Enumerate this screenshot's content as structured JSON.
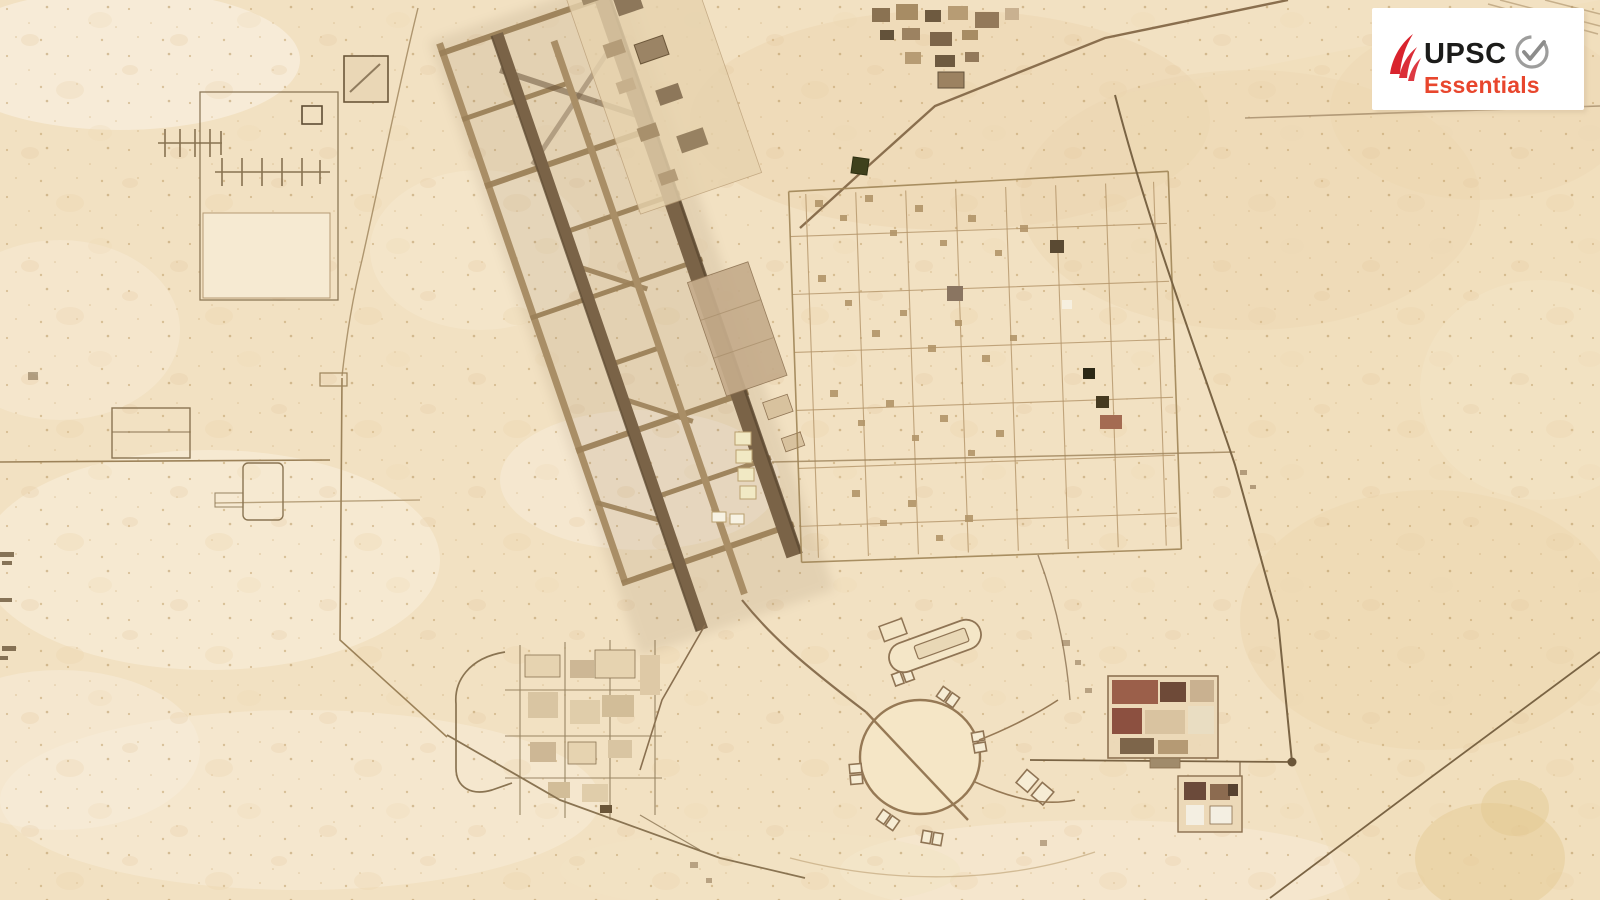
{
  "image": {
    "description": "Sepia-toned aerial satellite view of a desert airbase: two long parallel diagonal runways with taxiways and connectors, a large parking apron, dense support-facility grids to the east, a circular dispersal loop with parking pads at the south, antenna arrays and fenced compounds to the west, all surrounded by open sand.",
    "style": "satellite photograph"
  },
  "watermark": {
    "brand": "UPSC",
    "subtitle": "Essentials",
    "brand_color": "#1c1c1a",
    "subtitle_color": "#e8462d",
    "flame_color": "#d9232d",
    "check_color": "#9d9d9c",
    "card_bg": "#ffffff"
  },
  "map": {
    "colors": {
      "sand": "#f2e1c2",
      "sand_light": "#f8eeda",
      "sand_dark": "#e6cba2",
      "road": "#8a6f4e",
      "road_light": "#9c8159",
      "runway": "#7a6347",
      "taxiway": "#a98e66",
      "apron": "#c5ac8b",
      "band": "#e7d3ae",
      "building": "#9c8665",
      "building_dark": "#63523a",
      "building_red": "#9b5f4a",
      "pale_yellow": "#f1e9c4",
      "dark_green": "#3f411d"
    },
    "features": [
      "antenna-array-field",
      "west-perimeter-road",
      "parallel-runways",
      "parallel-taxiways",
      "runway-connectors",
      "main-apron-band",
      "large-parking-apron",
      "east-facility-grid",
      "east-perimeter-road",
      "circular-dispersal-loop",
      "dispersal-pads",
      "stadium-loop-pad",
      "southwest-support-compound",
      "southeast-compounds",
      "desert-terrain"
    ]
  }
}
